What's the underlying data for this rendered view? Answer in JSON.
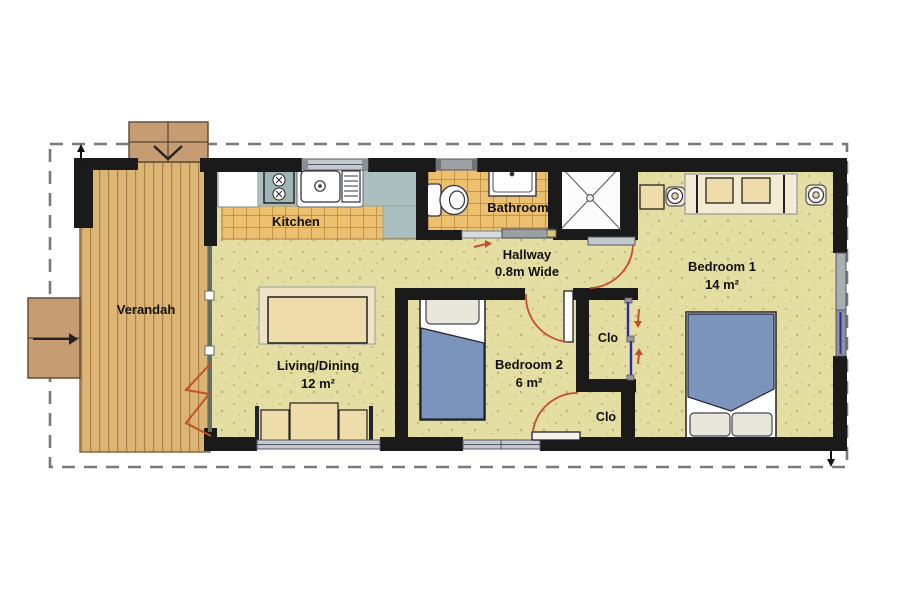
{
  "rooms": {
    "verandah": {
      "label": "Verandah"
    },
    "kitchen": {
      "label": "Kitchen"
    },
    "bathroom": {
      "label": "Bathroom"
    },
    "hallway": {
      "label": "Hallway",
      "width_note": "0.8m Wide"
    },
    "living_dining": {
      "label": "Living/Dining",
      "area": "12 m²"
    },
    "bedroom1": {
      "label": "Bedroom 1",
      "area": "14 m²"
    },
    "bedroom2": {
      "label": "Bedroom 2",
      "area": "6 m²"
    },
    "closet_top": {
      "label": "Clo"
    },
    "closet_bottom": {
      "label": "Clo"
    }
  },
  "colors": {
    "wall": "#1a1a1a",
    "floor_khaki": "#e5dea2",
    "tile_orange": "#ecc06f",
    "deck_wood": "#dcb474",
    "counter_gray": "#acbfbf",
    "bed_blue": "#7b94bc",
    "furniture_tan": "#eedcab",
    "door_swing_red": "#c3502c",
    "sliding_door_blue": "#2a2ab0",
    "window_gray": "#c4c9cc",
    "boundary_dash_gray": "#7a7a7a",
    "steps_brown": "#c69d73"
  }
}
